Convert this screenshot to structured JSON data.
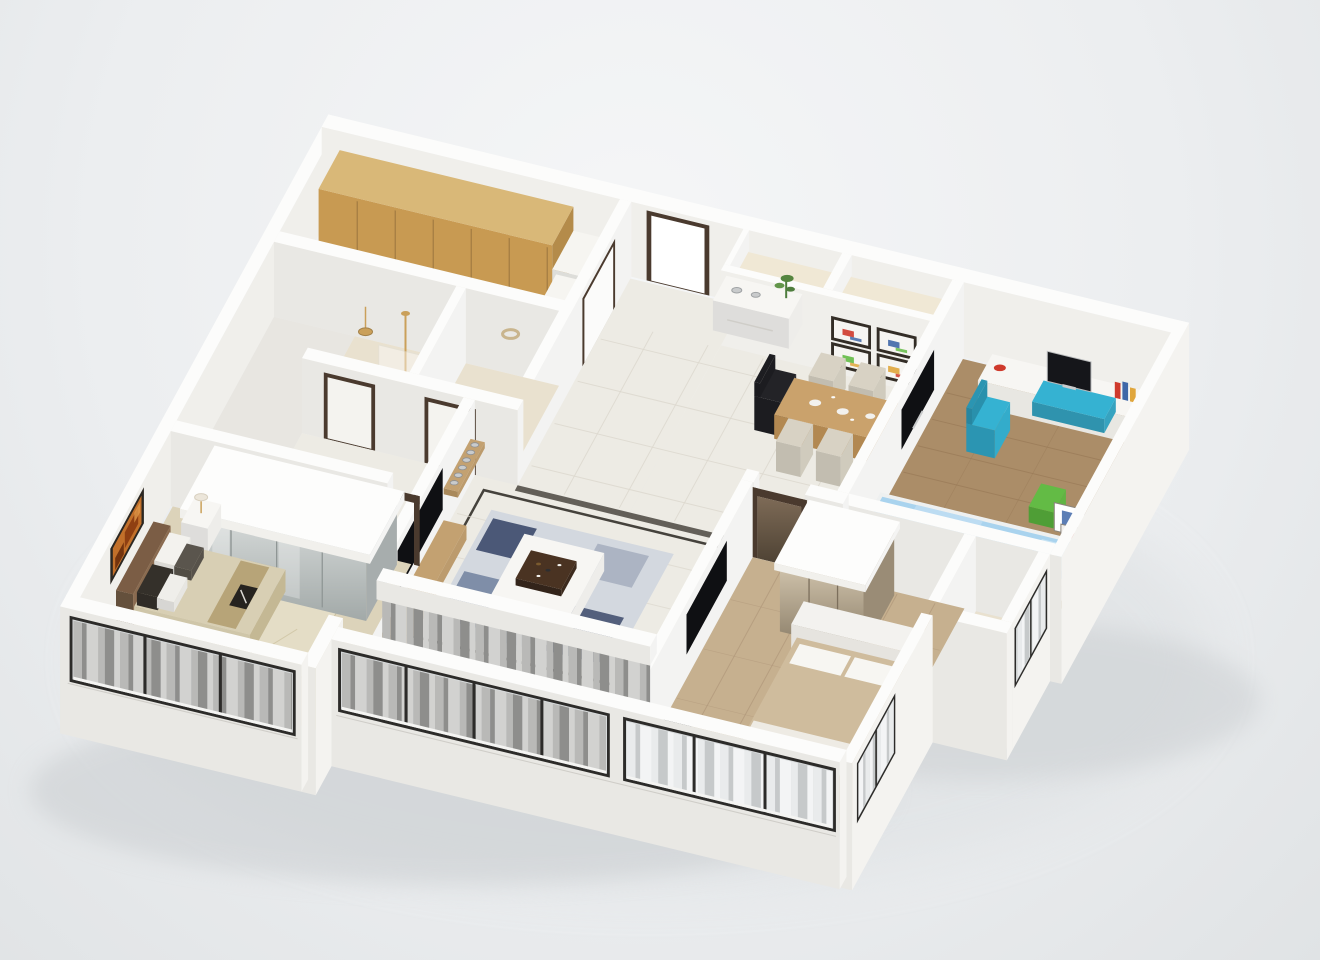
{
  "scene": {
    "kind": "3d-isometric-apartment-floorplan-render",
    "view": "cutaway-top-down-oblique",
    "background_top": "#f5f6f7",
    "background_mid": "#eceef0",
    "background_bottom": "#e0e3e5",
    "ground_shadow": "#c7cbce"
  },
  "palette": {
    "wallTop": "#fcfcfb",
    "wallFace": "#e9e8e4",
    "wallSide": "#f4f3f0",
    "wallInner": "#f0efeb",
    "plinth": "#dddcd7",
    "tile": "#edebe4",
    "tileLine": "#dcd8ce",
    "tileBorder": "#45423c",
    "bathTile": "#e9e1cf",
    "cream": "#f0e8d5",
    "carpet": "#dcd3ba",
    "rugArea": "#e4ddc6",
    "woodBed2": "#c6b08f",
    "woodBed2Dark": "#b0977a",
    "woodKids": "#ab8d68",
    "woodKidsDark": "#997a57",
    "cabinet": "#d9b878",
    "cabinetFace": "#c89a52",
    "counter": "#f6f5f1",
    "consoleWood": "#c3a171",
    "tableWood": "#caa26c",
    "tvBlack": "#0f1013",
    "windowFrame": "#2c2b29",
    "glass": "#d7dadb",
    "curtainGrayA": "#b9b9b7",
    "curtainGrayB": "#8e8e8c",
    "curtainGrayC": "#d2d2d0",
    "curtainLightA": "#e9ebec",
    "curtainLightB": "#c6c9ca",
    "curtainLightC": "#f3f4f5",
    "doorFrame": "#4a3a2e",
    "headboard": "#7b5d45",
    "bedSpread": "#d8cfb4",
    "bedRunner": "#b7a478",
    "bedTan": "#cfbc9d",
    "bedWhite": "#f3f2ef",
    "pillowDark": "#34302a",
    "kidsBlue": "#a9d3ee",
    "kidsBlueLight": "#c9e4f4",
    "teal": "#35b2d2",
    "green": "#63bb45",
    "red": "#cf3a2c",
    "amber": "#e0a63c",
    "purple": "#9b7fb8",
    "blue": "#3f67a8",
    "silver": "#c9cbcc",
    "gold": "#caa05a",
    "plant": "#4e7d3d",
    "artOrange": "#c2702a",
    "artRust": "#8a3a10",
    "rugBase": "#d3d8df",
    "rugNavy": "#3c4a6b",
    "rugBlue": "#70819f",
    "rugGray": "#a7b0c0",
    "mirrorHi": "#d6dad9",
    "mirrorLo": "#a2a9a8",
    "glossHi": "#cfc2ab",
    "glossLo": "#877a64",
    "whiteFurn": "#f7f6f3"
  },
  "rooms": [
    {
      "id": "kitchen",
      "features": [
        "wood-wall-cabinets",
        "white-counter",
        "tile-floor"
      ]
    },
    {
      "id": "entry-hallway",
      "features": [
        "open-entry-door",
        "kitchen-door",
        "white-tile-floor",
        "white-sideboard",
        "silver-vases",
        "potted-plant"
      ]
    },
    {
      "id": "dining-area",
      "features": [
        "wood-dining-table",
        "beige-chairs",
        "black-office-chair",
        "four-framed-artworks",
        "two-ceiling-niches",
        "white-dishes"
      ]
    },
    {
      "id": "bathroom-shower",
      "features": [
        "gold-shower-fixture",
        "pendant-lamp",
        "glass-partition",
        "beige-tile-floor"
      ]
    },
    {
      "id": "bathroom-second",
      "features": [
        "wall-wreath",
        "beige-tile-floor"
      ]
    },
    {
      "id": "master-bedroom",
      "features": [
        "mirrored-wardrobe-white-canopy",
        "leather-headboard-bed",
        "damask-pillows",
        "bed-runner",
        "magazine",
        "nightstand",
        "table-lamp",
        "abstract-orange-artwork",
        "patterned-carpet",
        "bay-window-gray-curtains"
      ]
    },
    {
      "id": "living-room",
      "features": [
        "wall-tv",
        "wood-media-console",
        "silver-decor-spheres-shelf",
        "dark-vase",
        "camouflage-rug",
        "white-coffee-table",
        "dark-serving-tray",
        "dark-tile-border",
        "gray-curtain-wall"
      ]
    },
    {
      "id": "living-balcony",
      "features": [
        "round-white-table",
        "tile-floor",
        "window-wall-gray-curtains"
      ]
    },
    {
      "id": "second-bedroom",
      "features": [
        "white-frame-bed-tan-cover",
        "wall-tv",
        "glossy-wardrobe-white-canopy",
        "glossy-mirror-door",
        "radiator",
        "round-side-table",
        "wood-plank-floor",
        "front-windows",
        "side-window"
      ]
    },
    {
      "id": "kids-study-room",
      "features": [
        "white-desk",
        "desktop-computer",
        "teal-desk-chair",
        "teal-drawer-unit",
        "red-decor-plate",
        "books",
        "leaning-picture-frames",
        "green-stool",
        "blue-kids-bed",
        "plush-toys",
        "wall-tv",
        "wood-plank-floor",
        "side-window-white-curtains"
      ]
    }
  ]
}
